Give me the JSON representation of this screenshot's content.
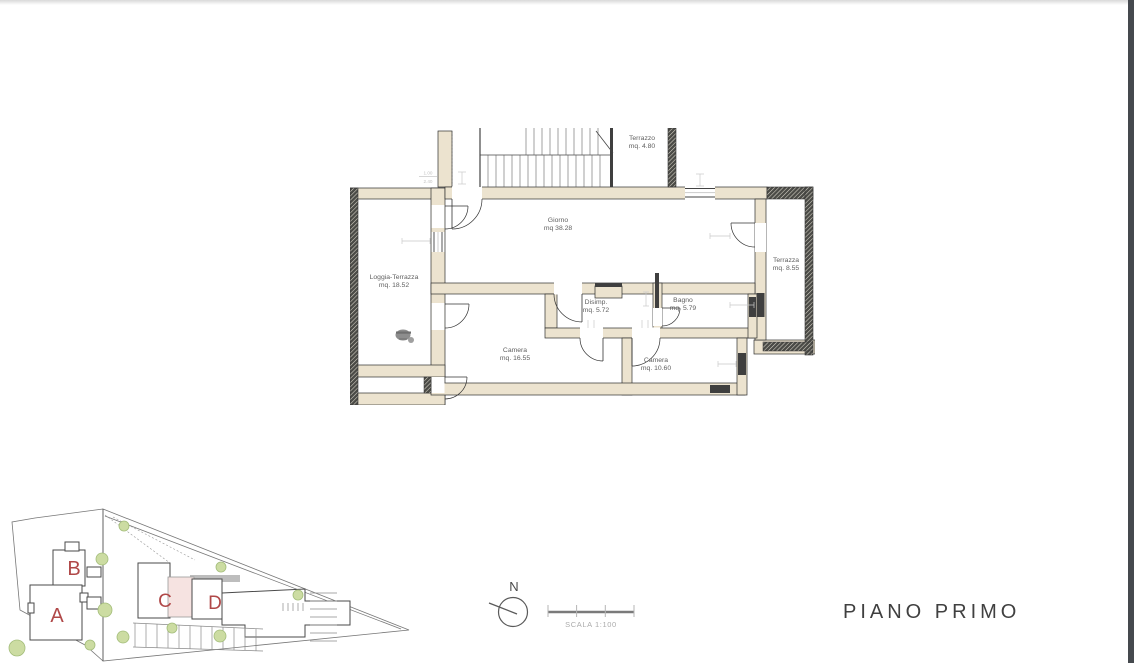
{
  "window": {
    "background": "#ffffff",
    "scrollbar_color": "#45494e",
    "top_edge_color": "#d9d9d9"
  },
  "floor_plan": {
    "rooms": [
      {
        "id": "terrazzo",
        "name": "Terrazzo",
        "area": "mq. 4.80"
      },
      {
        "id": "giorno",
        "name": "Giorno",
        "area": "mq 38.28"
      },
      {
        "id": "loggia",
        "name": "Loggia-Terrazza",
        "area": "mq. 18.52"
      },
      {
        "id": "terrazza",
        "name": "Terrazza",
        "area": "mq. 8.55"
      },
      {
        "id": "disimpegno",
        "name": "Disimp.",
        "area": "mq. 5.72"
      },
      {
        "id": "bagno",
        "name": "Bagno",
        "area": "mq. 5.79"
      },
      {
        "id": "camera-grande",
        "name": "Camera",
        "area": "mq. 16.55"
      },
      {
        "id": "camera-piccola",
        "name": "Camera",
        "area": "mq. 10.60"
      }
    ],
    "dimension_label": {
      "top": "1.00",
      "bottom": "2.40"
    },
    "colors": {
      "wall_fill": "#ece3cf",
      "wall_line": "#2e2e2e",
      "hatch_dark": "#4a4a46",
      "label_text": "#5f5f5f",
      "dimension_text": "#c2c2c2"
    }
  },
  "site_plan": {
    "buildings": [
      {
        "label": "A"
      },
      {
        "label": "B"
      },
      {
        "label": "C"
      },
      {
        "label": "D"
      }
    ],
    "colors": {
      "letter": "#b04848",
      "highlight_unit": "#f6e3e1",
      "tree": "#ccdca2",
      "outline": "#4a4a4a"
    }
  },
  "compass": {
    "north_label": "N"
  },
  "scale_bar": {
    "label": "SCALA 1:100"
  },
  "title": {
    "text": "PIANO PRIMO"
  }
}
